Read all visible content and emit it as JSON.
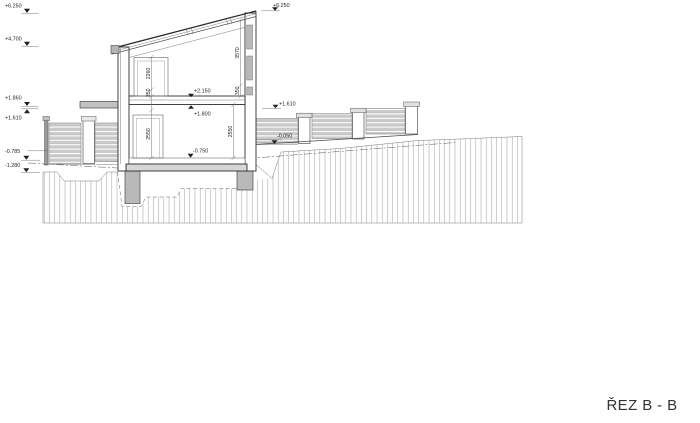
{
  "drawing": {
    "title": "ŘEZ B - B",
    "type_note": "architectural building cross-section",
    "markers": {
      "left": [
        {
          "label": "+6.250"
        },
        {
          "label": "+4.700"
        },
        {
          "label": "+1.860"
        },
        {
          "label": "+1.610"
        },
        {
          "label": "-0.785"
        },
        {
          "label": "-1.280"
        }
      ],
      "right": [
        {
          "label": "+6.250"
        },
        {
          "label": "+1.610"
        },
        {
          "label": "-0.050"
        }
      ],
      "interior": [
        {
          "label": "+2.150"
        },
        {
          "label": "+1.800"
        },
        {
          "label": "-0.750"
        }
      ]
    },
    "dimensions": [
      {
        "label": "2260"
      },
      {
        "label": "350"
      },
      {
        "label": "3570"
      },
      {
        "label": "350"
      },
      {
        "label": "2550"
      },
      {
        "label": "2550"
      }
    ],
    "colors": {
      "paper": "#ffffff",
      "line": "#4a4a4a",
      "bold_line": "#2b2b2b",
      "concrete_fill": "#b9b9b9",
      "slat_fill": "#cccccc",
      "hatch_line": "#a5a5a5",
      "text": "#1f1f1f"
    }
  }
}
